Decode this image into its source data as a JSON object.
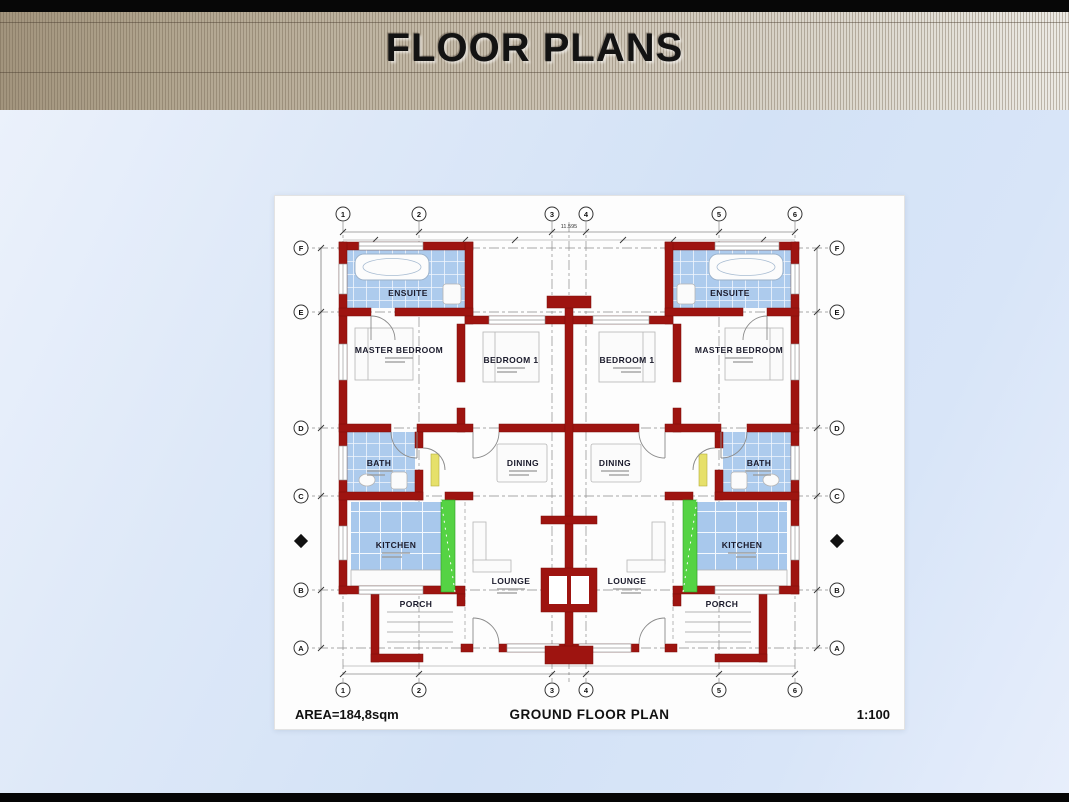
{
  "header": {
    "title": "FLOOR PLANS"
  },
  "plan": {
    "footer": {
      "area_label": "AREA=184,8sqm",
      "drawing_title": "GROUND FLOOR PLAN",
      "scale_label": "1:100"
    },
    "rooms": {
      "ensuite": "ENSUITE",
      "master_bedroom": "MASTER BEDROOM",
      "bedroom1": "BEDROOM 1",
      "bath": "BATH",
      "dining": "DINING",
      "kitchen": "KITCHEN",
      "lounge": "LOUNGE",
      "porch": "PORCH"
    },
    "grid": {
      "top": [
        "1",
        "2",
        "3",
        "4",
        "5",
        "6"
      ],
      "bottom": [
        "1",
        "2",
        "3",
        "4",
        "5",
        "6"
      ],
      "left": [
        "F",
        "E",
        "D",
        "C",
        "B",
        "A"
      ],
      "right": [
        "F",
        "E",
        "D",
        "C",
        "B",
        "A"
      ]
    },
    "dimensions": {
      "overall_width": "11.595"
    },
    "colors": {
      "wall_red": "#9e1410",
      "tile_blue": "#adcbed",
      "hatch_green": "#55d344",
      "door_yellow": "#e6e06a",
      "header_tan": "#c3b9a7",
      "background_blue": "#d8e5f8"
    }
  }
}
